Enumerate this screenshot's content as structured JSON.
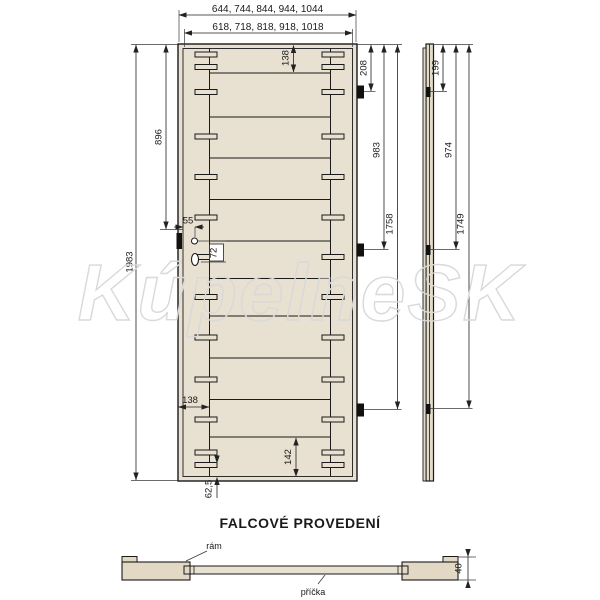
{
  "watermark": "KúpelneSK",
  "section_title": "FALCOVÉ PROVEDENÍ",
  "front_view": {
    "width_outer": "644, 744, 844, 944, 1044",
    "width_inner": "618, 718, 818, 918, 1018",
    "height_total": "1983",
    "handle_height_from_top": "896",
    "top_rail": "138",
    "stile_width": "138",
    "bottom_rail": "142",
    "bottom_dowel_offset": "62,5",
    "handle_backset": "55",
    "handle_hole_spacing": "72",
    "hinge_top": "208",
    "hinge_middle": "983",
    "hinge_bottom": "1758"
  },
  "side_view": {
    "hinge_top": "199",
    "hinge_middle": "974",
    "hinge_bottom": "1749"
  },
  "section_view": {
    "label_frame": "rám",
    "label_crossbar": "příčka",
    "thickness": "40"
  },
  "colors": {
    "wood_fill": "#e8e0d0",
    "wood_fill_section": "#e2d8c4",
    "line": "#1a1a1a",
    "dimension_line": "#3a3a3a",
    "watermark": "#d9d9d9"
  }
}
